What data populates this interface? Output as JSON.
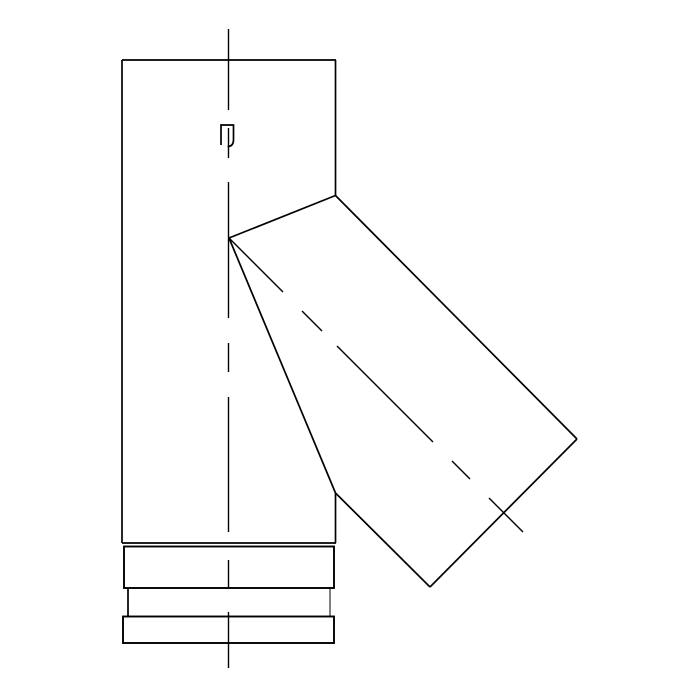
{
  "canvas": {
    "width": 700,
    "height": 700,
    "background_color": "#ffffff",
    "line_color": "#000000"
  },
  "drawing": {
    "description": "Technical line drawing: vertical pipe section with 45-degree branch (tee/lateral flue fitting), front view, with dash-dot centerlines, seam lock tab detail and socket collar bands at the bottom",
    "stroke_widths": {
      "outline": 1.7,
      "band": 1.9,
      "centerline": 1.4,
      "thin": 1.0
    },
    "outline_segments": [
      {
        "name": "main-pipe-left-edge",
        "x1": 122,
        "y1": 60,
        "x2": 122,
        "y2": 543
      },
      {
        "name": "main-pipe-top-edge",
        "x1": 122,
        "y1": 60,
        "x2": 336,
        "y2": 60
      },
      {
        "name": "main-pipe-right-edge-upper",
        "x1": 335.5,
        "y1": 60,
        "x2": 335.5,
        "y2": 195.5
      },
      {
        "name": "main-pipe-right-edge-lower",
        "x1": 335.5,
        "y1": 493,
        "x2": 335.5,
        "y2": 543
      },
      {
        "name": "main-pipe-bottom-edge",
        "x1": 122,
        "y1": 543,
        "x2": 336,
        "y2": 543
      },
      {
        "name": "branch-miter-upper-joint",
        "x1": 229,
        "y1": 238,
        "x2": 335.5,
        "y2": 195.5
      },
      {
        "name": "branch-top-edge",
        "x1": 335.5,
        "y1": 195.5,
        "x2": 577,
        "y2": 439
      },
      {
        "name": "branch-end-face",
        "x1": 577,
        "y1": 439,
        "x2": 430,
        "y2": 587
      },
      {
        "name": "branch-bottom-edge",
        "x1": 430,
        "y1": 587,
        "x2": 335.5,
        "y2": 493
      },
      {
        "name": "branch-miter-lower-joint",
        "x1": 335.5,
        "y1": 493,
        "x2": 229,
        "y2": 238
      }
    ],
    "collar_bands": [
      {
        "name": "collar-band-upper",
        "type": "rect",
        "x": 124,
        "y": 546.5,
        "w": 210,
        "h": 41.5
      },
      {
        "name": "collar-band-lower",
        "type": "rect",
        "x": 123,
        "y": 616.5,
        "w": 211,
        "h": 26.5
      }
    ],
    "collar_band_middle_edges": [
      {
        "name": "collar-band-middle-left-edge",
        "x1": 128,
        "y1": 588,
        "x2": 128,
        "y2": 616,
        "width_key": "outline"
      },
      {
        "name": "collar-band-middle-right-edge",
        "x1": 330,
        "y1": 588,
        "x2": 330,
        "y2": 616,
        "width_key": "thin"
      }
    ],
    "vertical_centerline": {
      "name": "vertical-centerline",
      "x": 228.5,
      "dash_segments": [
        [
          29,
          110
        ],
        [
          128,
          158
        ],
        [
          182,
          318
        ],
        [
          343,
          372
        ],
        [
          397,
          532
        ],
        [
          560,
          587
        ],
        [
          612,
          668
        ]
      ]
    },
    "branch_centerline": {
      "name": "branch-centerline",
      "dash_segments": [
        [
          229,
          238,
          283,
          292
        ],
        [
          302,
          311,
          322,
          331
        ],
        [
          337,
          346,
          433,
          442
        ],
        [
          452,
          461,
          470,
          479
        ],
        [
          489,
          498,
          523,
          532
        ]
      ]
    },
    "seam_tab": {
      "name": "seam-lock-tab",
      "path": "M 221,145 L 221,125 L 233.5,125 L 233.5,139.5 Q 233.5,146.5 227.5,146.5"
    }
  }
}
